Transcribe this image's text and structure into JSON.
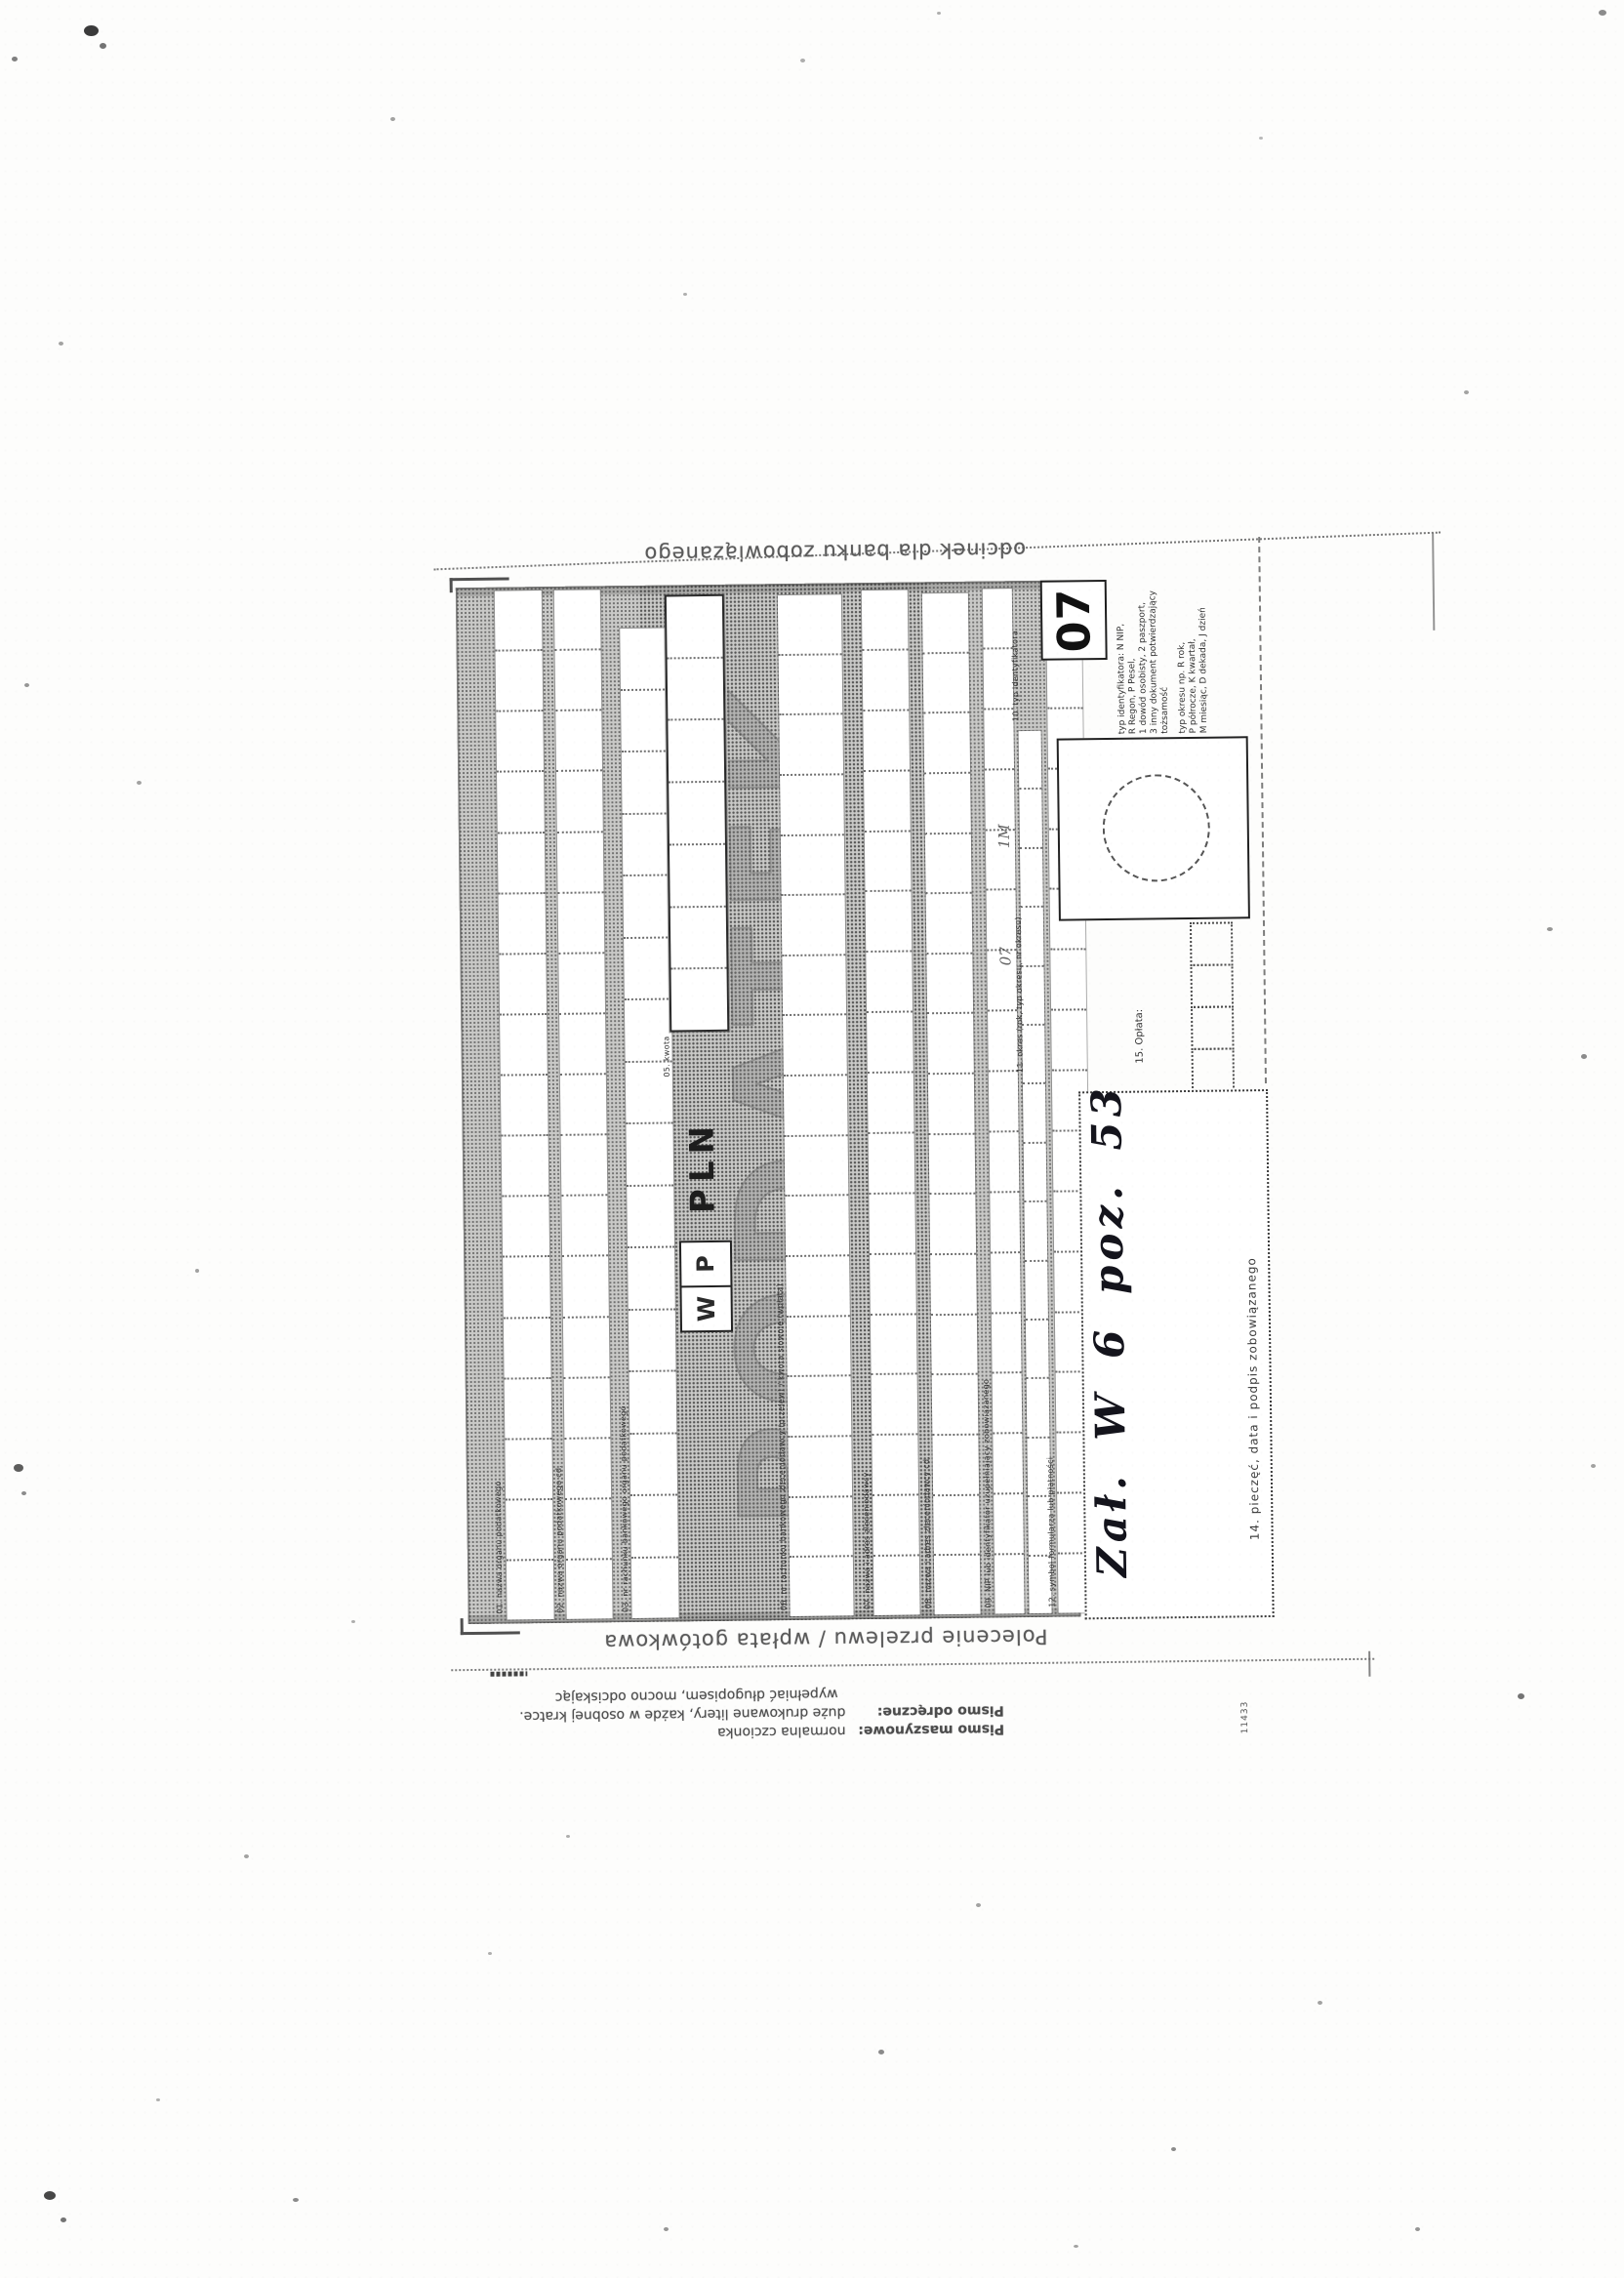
{
  "scan": {
    "captions": {
      "top": "odcinek dla banku zobowiązanego",
      "bottom": "Polecenie przelewu / wpłata gotówkowa"
    },
    "watermark": "PODATEK",
    "handwriting": "Zał. W 6 poz. 53",
    "form_number": "11433",
    "values": {
      "symbol": "07",
      "currency": "PLN",
      "waluta": [
        "W",
        "P"
      ],
      "okres_marks": [
        "1M",
        "07"
      ]
    },
    "fields": {
      "f01": "01. nazwa organu podatkowego",
      "f02": "02. nazwa organu podatkowego cd.",
      "f03": "03. nr rachunku bankowego organu podatkowego",
      "f05": "05. kwota",
      "f06": "06. nr rachunku bankowego zleceniodawcy (przelew) / kwota słownie (wpłata)",
      "f07": "07. nazwa i adres zleceniodawcy",
      "f08": "08. nazwa i adres zleceniodawcy cd.",
      "f09": "09. NIP lub identyfikator uzupełniający zobowiązanego",
      "f10": "10. typ identyfikatora",
      "f11": "11. okres (rok, typ okresu, nr okresu)",
      "f12": "12. symbol formularza lub płatności",
      "f13": "13. identyfikacja zobowiązania (rodzaj dokumentu np. decyzja, tytuł wykonawczy, postanowienie)",
      "f14": "14. pieczęć, data i podpis zobowiązanego",
      "f15": "15. Opłata:"
    },
    "legend": {
      "identifier_lines": [
        "typ identyfikatora: N NIP,",
        "R Regon, P Pesel,",
        "1 dowód osobisty, 2 paszport,",
        "3 inny dokument potwierdzający",
        "tożsamość"
      ],
      "period_lines": [
        "typ okresu np. R rok,",
        "P półrocze, K kwartał,",
        "M miesiąc, D dekada, J dzień"
      ]
    },
    "instructions": {
      "row1_label": "Pismo maszynowe:",
      "row1_value": "normalna czcionka",
      "row2_label": "Pismo odręczne:",
      "row2_value": "duże drukowane litery, każde w osobnej kratce.",
      "row3_value": "wypełniać długopisem, mocno odciskając"
    }
  }
}
